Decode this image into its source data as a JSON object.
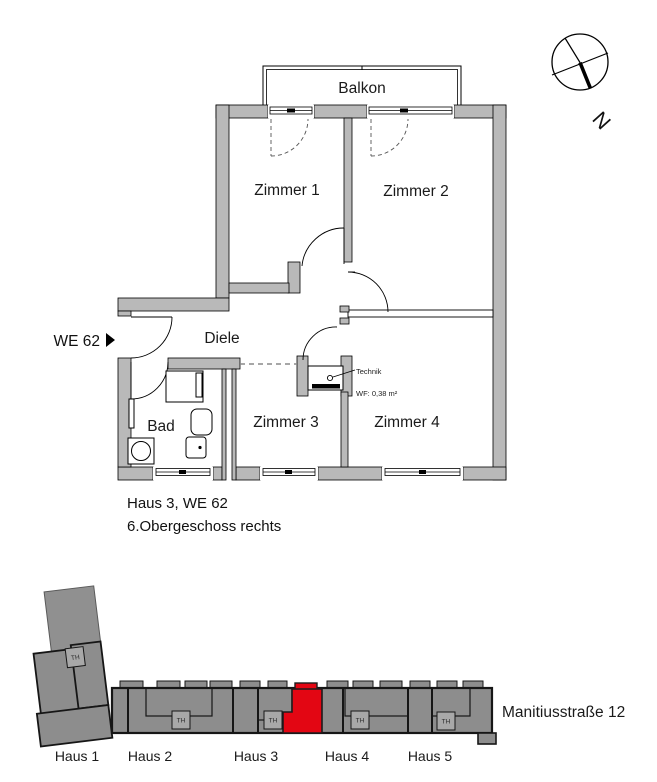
{
  "compass": {
    "north_label": "N"
  },
  "floor_plan": {
    "unit_label": "WE 62",
    "balcony_label": "Balkon",
    "rooms": [
      {
        "label": "Zimmer 1"
      },
      {
        "label": "Zimmer 2"
      },
      {
        "label": "Diele"
      },
      {
        "label": "Bad"
      },
      {
        "label": "Zimmer 3"
      },
      {
        "label": "Zimmer 4"
      }
    ],
    "technik_label": "Technik",
    "technik_area": "WF: 0,38 m²"
  },
  "title_block": {
    "caption_line1": "Haus 3, WE 62",
    "caption_line2": "6.Obergeschoss rechts"
  },
  "site_plan": {
    "street_label": "Manitiusstraße 12",
    "stairwell_label": "TH",
    "houses": [
      {
        "label": "Haus 1"
      },
      {
        "label": "Haus 2"
      },
      {
        "label": "Haus 3"
      },
      {
        "label": "Haus 4"
      },
      {
        "label": "Haus 5"
      }
    ],
    "highlighted_house": "Haus 3",
    "highlight_color": "#e30613"
  },
  "colors": {
    "wall_gray": "#b9b9b9",
    "building_gray": "#8d8d8d",
    "highlight_red": "#e30613"
  }
}
